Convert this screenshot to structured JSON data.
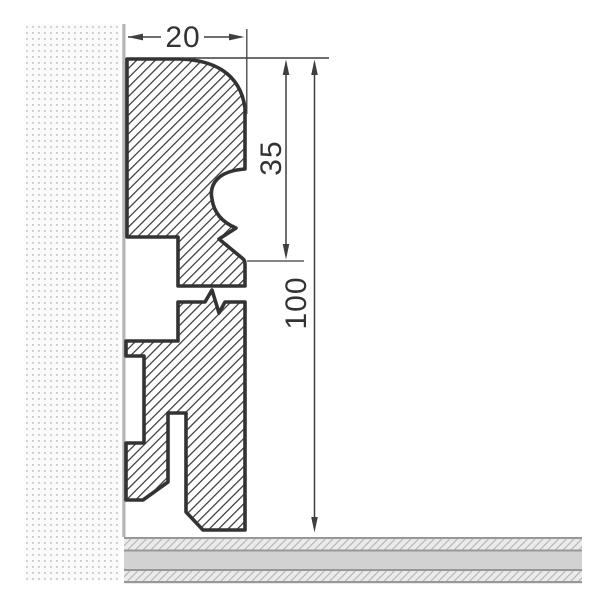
{
  "diagram": {
    "labels": {
      "width": "20",
      "upper_height": "35",
      "total_height": "100"
    },
    "colors": {
      "outline": "#333333",
      "hatch_line": "#3c3c3c",
      "dimension": "#3f3f3f",
      "text": "#333333",
      "wall_dots": "#c8c8c8",
      "wall_bg": "#fafafa",
      "wall_face": "#b5b5b5",
      "floor_line": "#989898",
      "floor_solid": "#d2d2d2",
      "floor_hatch_line": "#b3b3b3",
      "floor_hatch_bg": "#ebebeb",
      "background": "#ffffff"
    }
  }
}
